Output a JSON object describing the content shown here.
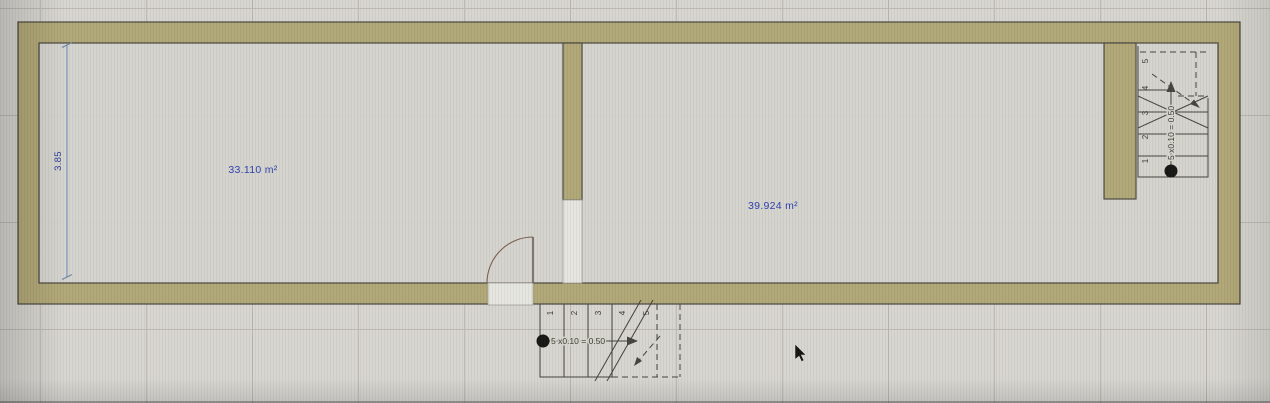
{
  "app": {
    "name": "floor-plan-editor",
    "view": "floor-plan-canvas"
  },
  "theme": {
    "canvas_bg": "#d7d5d0",
    "grid_line": "#8f8d86",
    "wall_fill": "#b1a777",
    "wall_outline": "#4c4a40",
    "room_fill": "#d4d3cc",
    "opening_fill": "#e6e5e0",
    "line_color": "#45433d",
    "annotation_blue": "#2e3fae",
    "dimension_line": "#92a9c4",
    "door_arc": "#7a5f52"
  },
  "rooms": {
    "left": {
      "area_label": "33.110 m²"
    },
    "right": {
      "area_label": "39.924 m²"
    }
  },
  "dimension": {
    "value": "3.85"
  },
  "stairs": {
    "bottom": {
      "formula": "5 x0.10 = 0.50",
      "steps": [
        "1",
        "2",
        "3",
        "4",
        "5"
      ]
    },
    "top_right": {
      "formula": "5 x0.10 = 0.50",
      "steps": [
        "1",
        "2",
        "3",
        "4",
        "5"
      ]
    }
  }
}
